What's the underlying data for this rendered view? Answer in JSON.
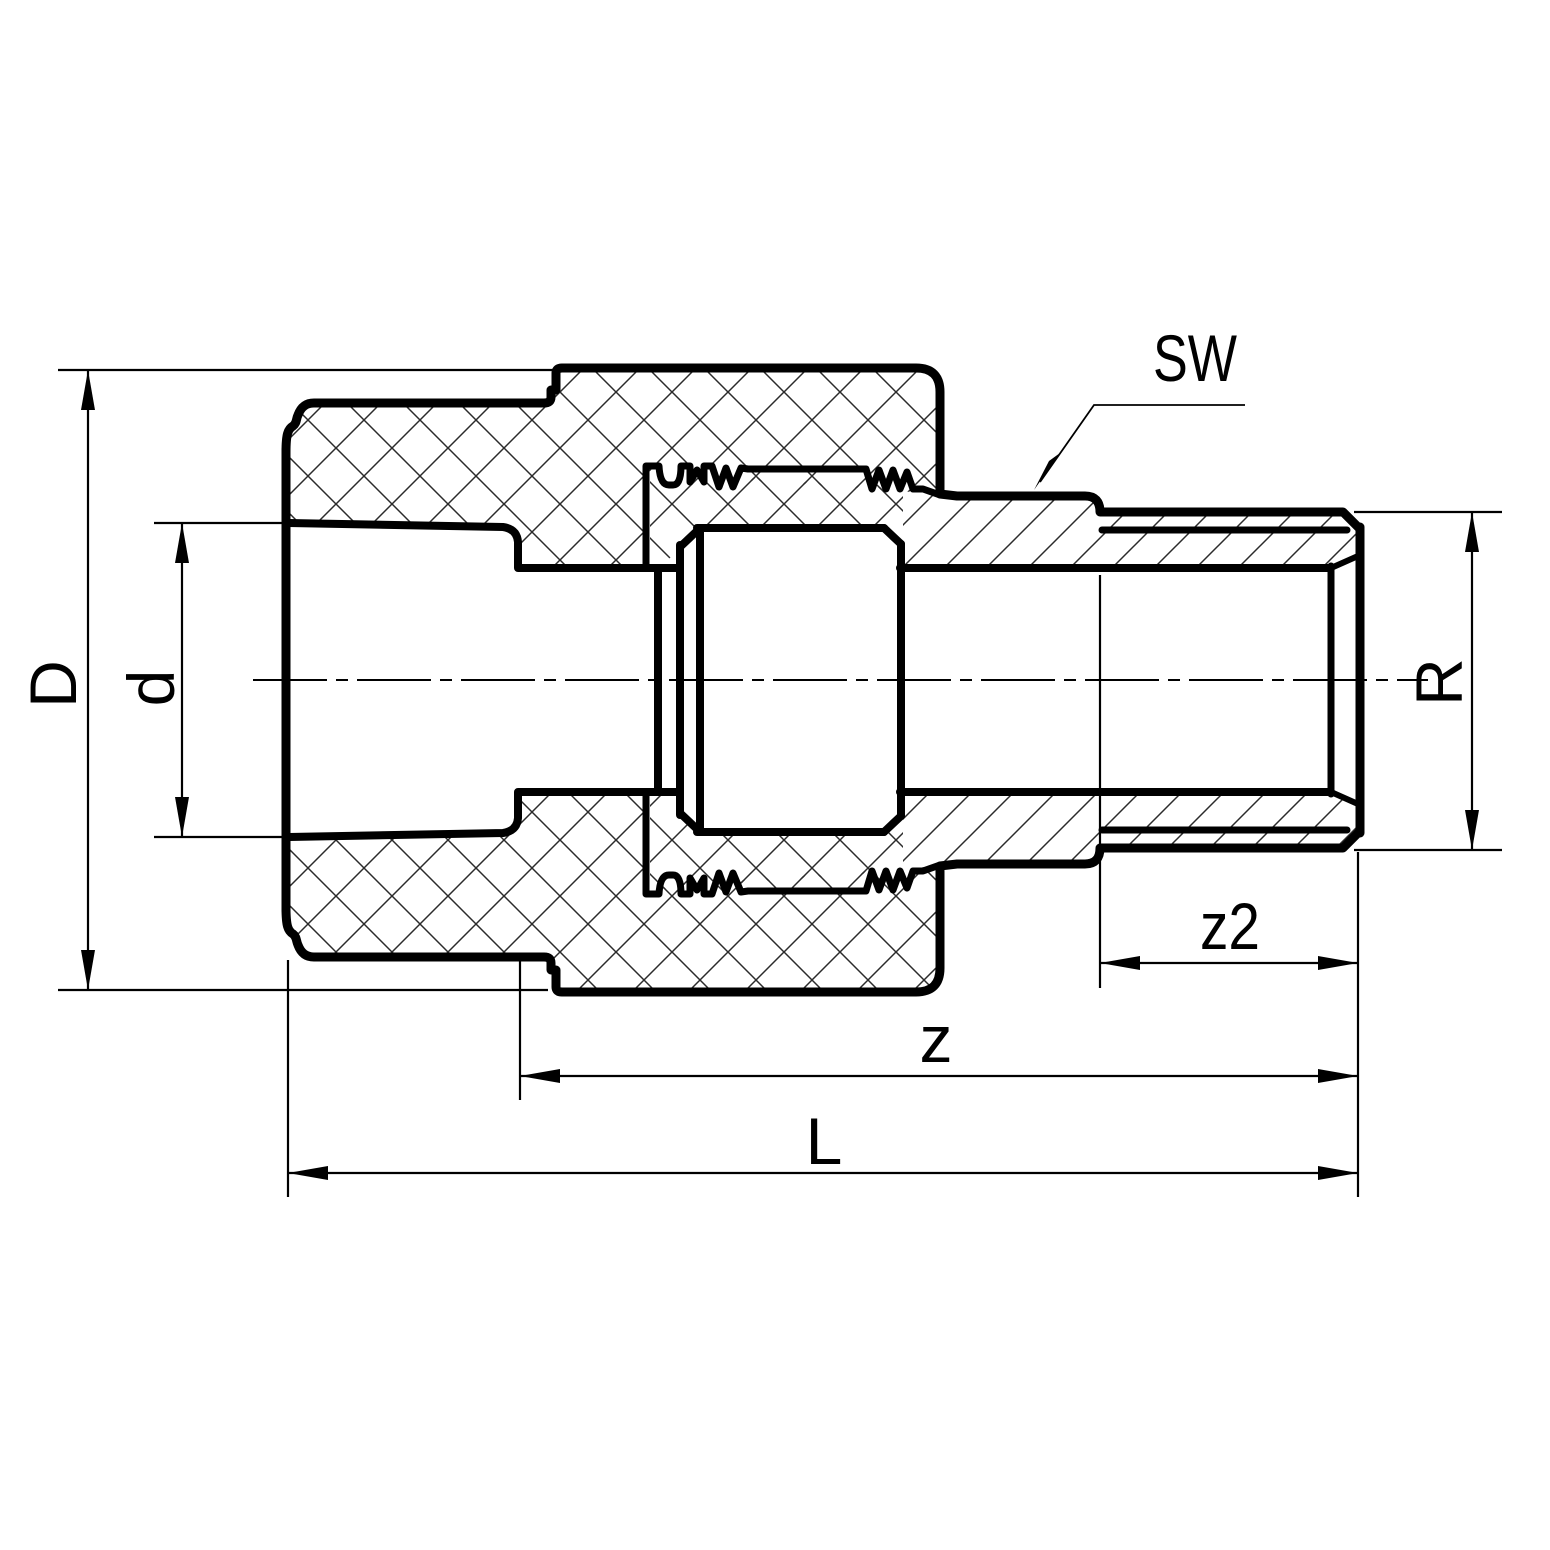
{
  "drawing": {
    "type": "technical-section-drawing",
    "colors": {
      "line": "#000000",
      "hatch": "#2b2b2b",
      "background": "#ffffff"
    },
    "dimensions": {
      "sw": "SW",
      "outer_diameter": "D",
      "socket_inner_diameter": "d",
      "thread_size": "R",
      "thread_length": "z2",
      "free_length": "z",
      "overall_length": "L"
    }
  }
}
